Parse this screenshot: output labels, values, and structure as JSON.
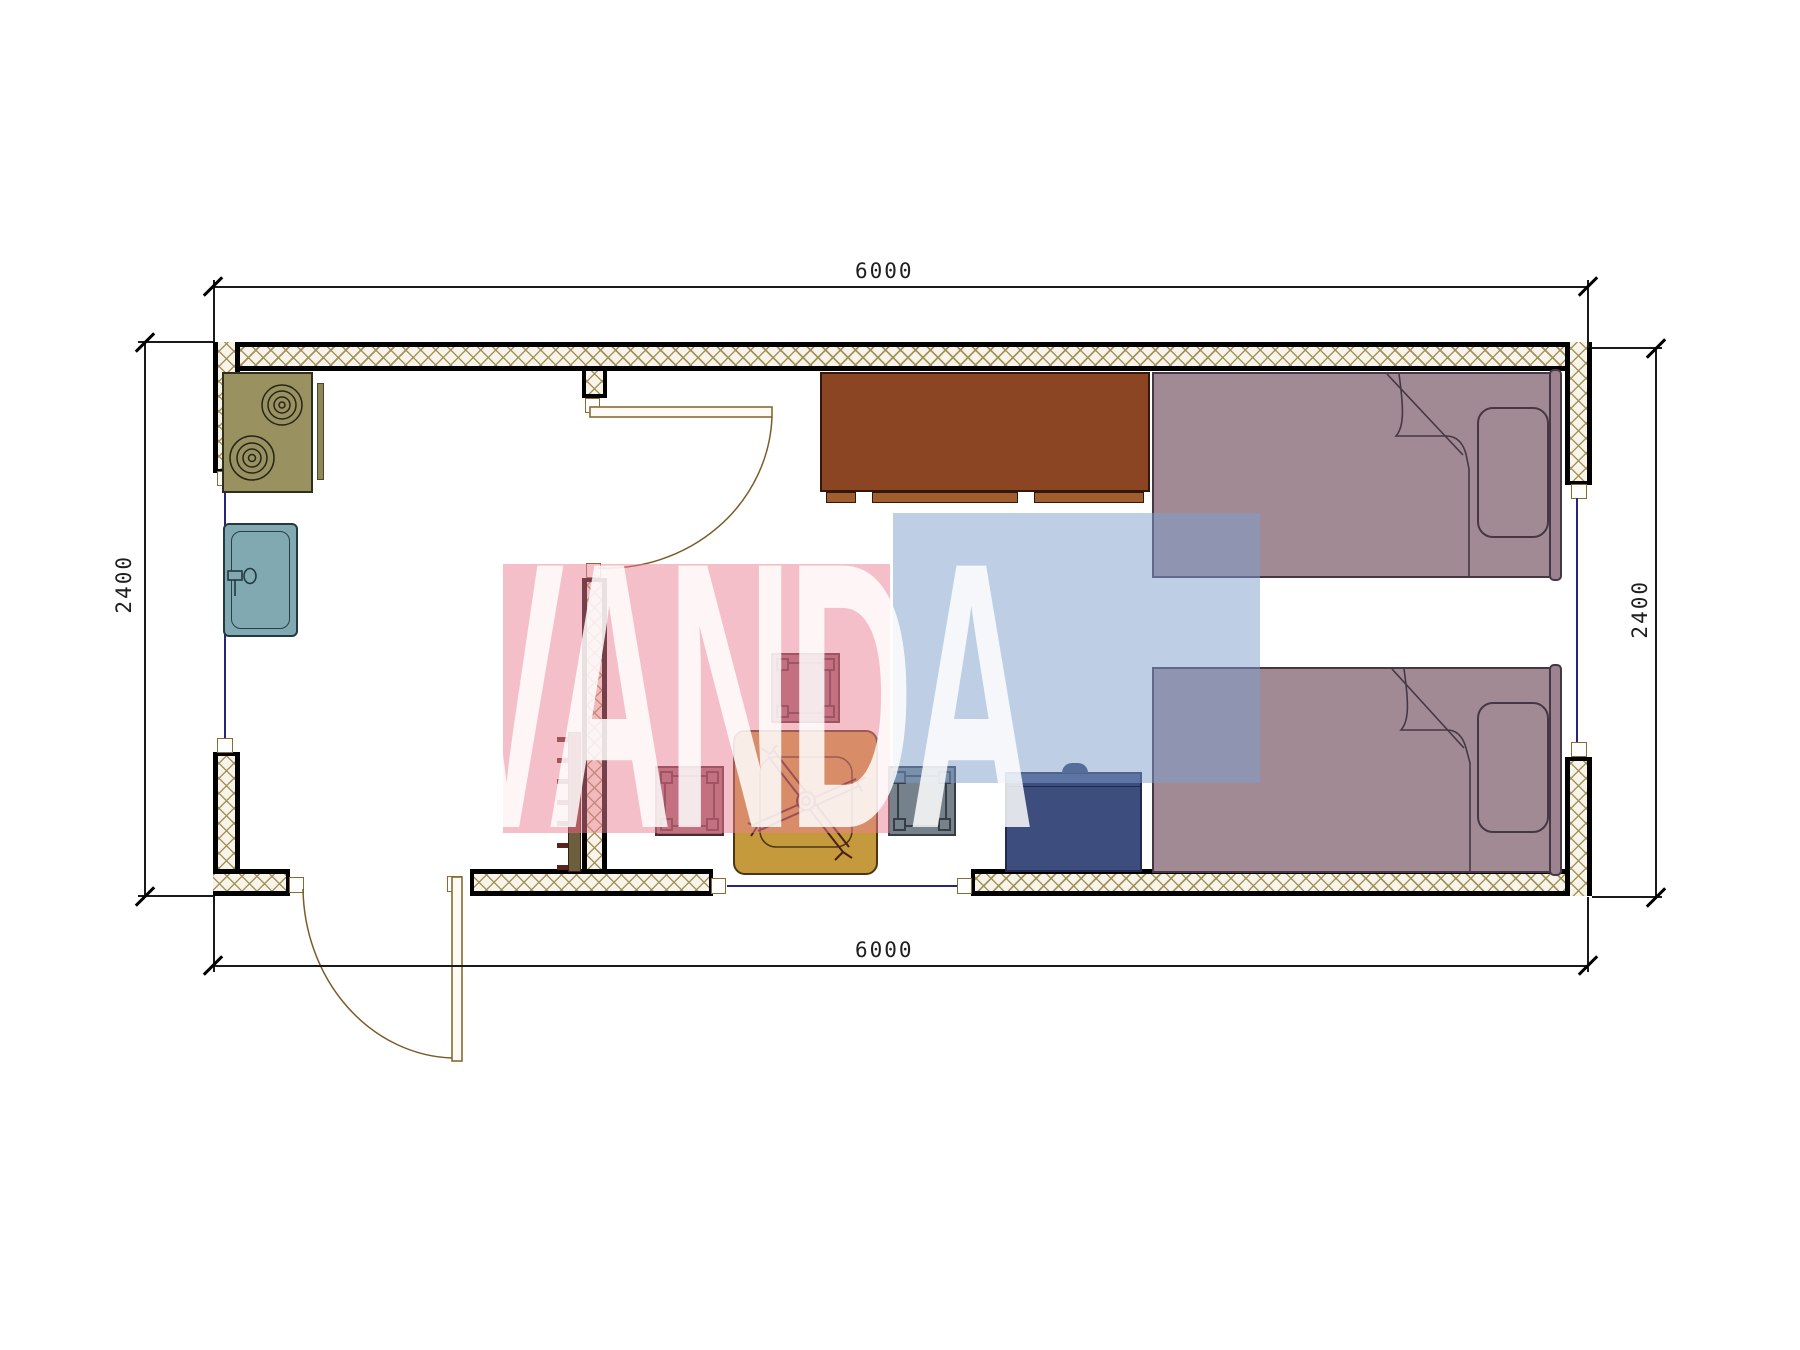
{
  "watermark": {
    "text": "VANDA",
    "pink_color": "#eb7f93",
    "blue_color": "#7b9dcb",
    "text_color": "#ffffff"
  },
  "dimensions": {
    "top": "6000",
    "bottom": "6000",
    "left": "2400",
    "right": "2400"
  },
  "colors": {
    "wall_hatch": "#a08f55",
    "wall_fill": "#f8f4e9",
    "wall_border": "#000000",
    "glazing": "#26267e",
    "stove": "#99915f",
    "sink": "#80a9b1",
    "cabinet": "#8b4523",
    "bed": "#a28a95",
    "nightstand": "#3d4d7e",
    "table": "#c59a3c",
    "stool_maroon": "#9a616c",
    "stool_gray": "#75828c",
    "radiator": "#7a3a33",
    "door_leaf": "#8a6a30"
  },
  "furniture": [
    {
      "name": "stove-cooktop"
    },
    {
      "name": "kitchen-sink"
    },
    {
      "name": "wardrobe-cabinet"
    },
    {
      "name": "bed-upper"
    },
    {
      "name": "bed-lower"
    },
    {
      "name": "pillow"
    },
    {
      "name": "nightstand"
    },
    {
      "name": "dining-table"
    },
    {
      "name": "stool"
    },
    {
      "name": "radiator"
    }
  ]
}
